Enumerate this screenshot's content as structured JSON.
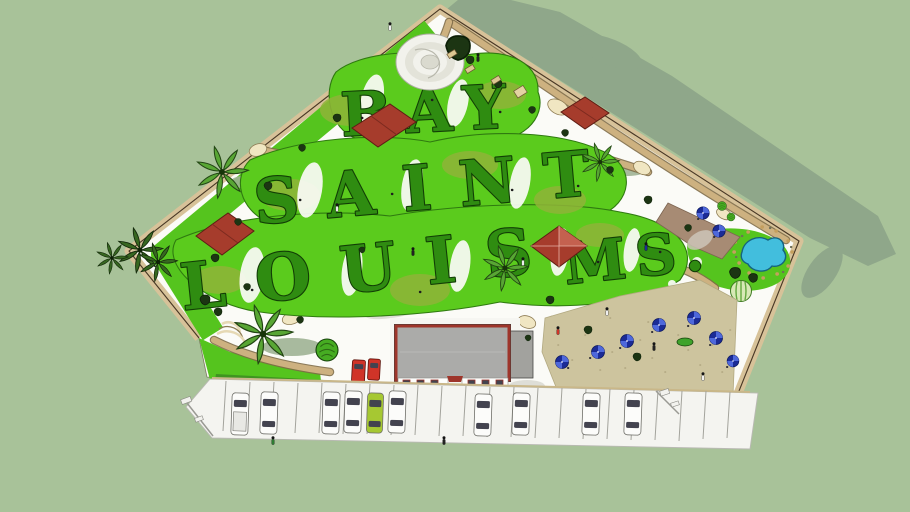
{
  "scene": {
    "description": "Aerial 3D model of a miniature golf park whose greens spell Bay Saint Louis MS, with clubhouse, patio and parking lot",
    "topiary_text": {
      "row1": "BAY",
      "row2": "SAINT",
      "row3": "LOUIS",
      "row4": "MS."
    },
    "full_text": "BAY SAINT LOUIS MS.",
    "colors": {
      "background": "#A8C299",
      "shadow": "#8FA78A",
      "ground_white": "#FBFBF7",
      "wall_tan": "#D7C299",
      "wall_line": "#4A3926",
      "path_tan": "#CDB180",
      "path_edge": "#7E6C47",
      "pad_cream": "#F0E6C2",
      "fairway_lime": "#5BCB1D",
      "fairway_olive": "#8FB438",
      "lawn_green": "#55C41E",
      "letter_green": "#2F8C11",
      "letter_outline": "#123D06",
      "canopy_red": "#A63C2C",
      "roof_gray": "#ABABA9",
      "roof_trim_red": "#9E352B",
      "pool_blue": "#42BEDD",
      "umbrella_navy": "#1B2B96",
      "umbrella_blue": "#4E68DB",
      "sand_tan": "#CDC49E",
      "paver_brown": "#A78B74",
      "parking_gray": "#F4F4F0",
      "car_white": "#FCFCFA",
      "car_green": "#A6C832",
      "car_red": "#D03428",
      "tree_dark": "#1C3513",
      "palm_green": "#58A634",
      "rock_tan": "#C49F5E"
    },
    "counts": {
      "red_canopies": 4,
      "blue_umbrellas": 9,
      "parking_lot_cars": 10,
      "service_vehicles": 2,
      "palm_trees": 7
    },
    "features": [
      "topiary letter golf greens",
      "red shade canopies",
      "spiral mound",
      "clubhouse with gray roof",
      "picnic patio with blue umbrellas",
      "rock-edged pond",
      "paver patio",
      "palm trees",
      "curved steps",
      "winding cart paths",
      "perimeter wall",
      "parking lot"
    ]
  }
}
